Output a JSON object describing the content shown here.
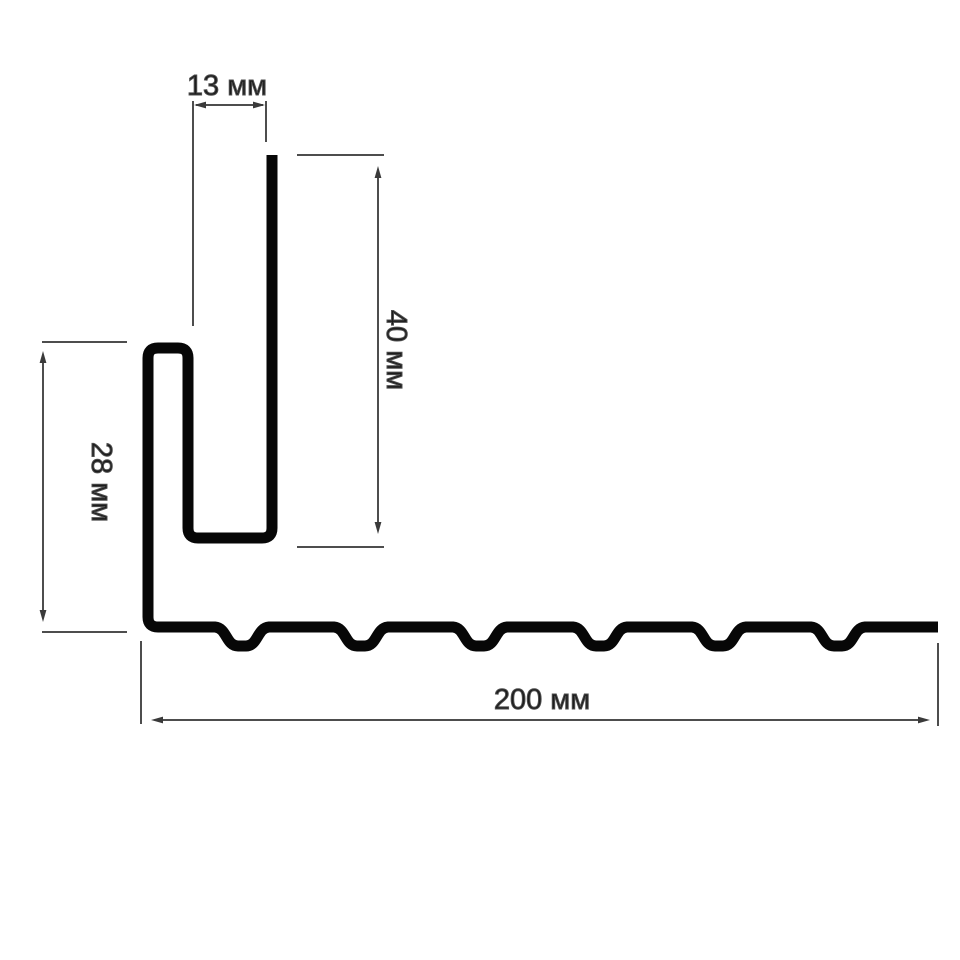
{
  "drawing": {
    "description": "Cross-section profile drawing of a siding trim with dimension callouts",
    "background_color": "#ffffff",
    "profile_color": "#070707",
    "dimension_color": "#4d4d4d",
    "label_color": "#1c1c1c",
    "unit": "мм",
    "labels": {
      "top_width": "13 мм",
      "flange_height": "40 мм",
      "left_height": "28 мм",
      "base_length": "200 мм"
    },
    "values": {
      "top_width_mm": 13,
      "flange_height_mm": 40,
      "left_height_mm": 28,
      "base_length_mm": 200
    }
  }
}
